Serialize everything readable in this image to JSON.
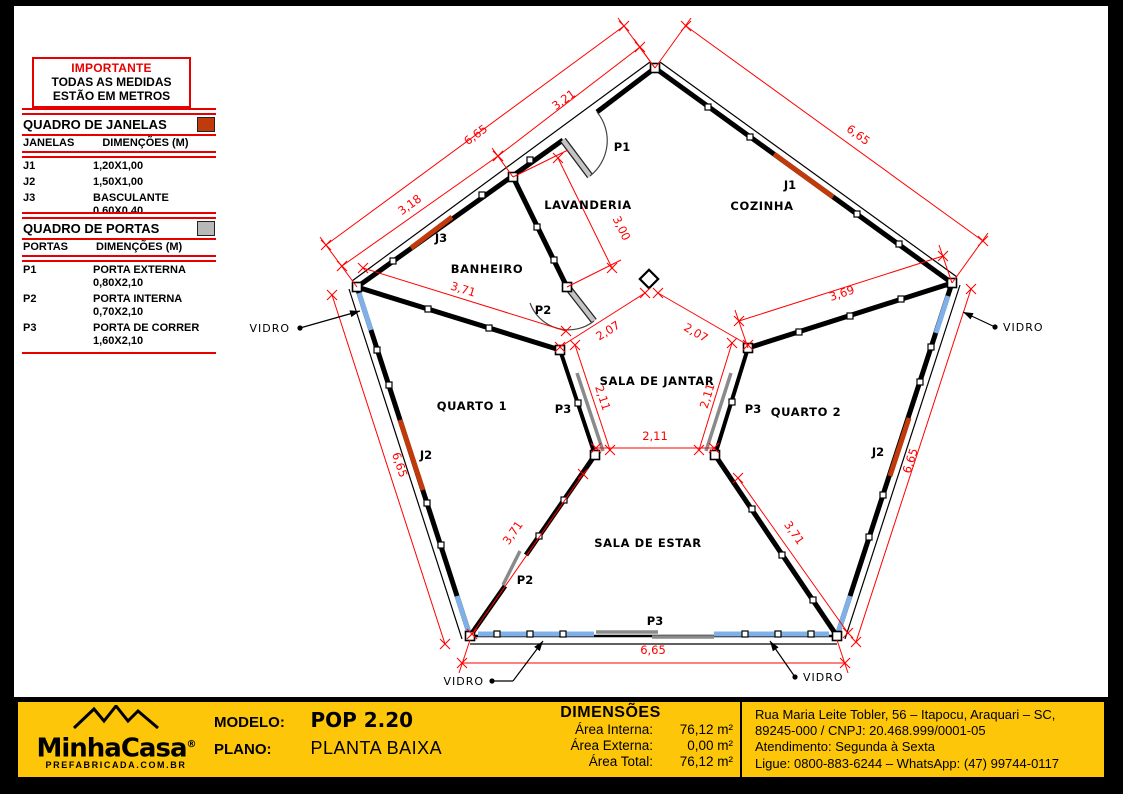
{
  "notice": {
    "title": "IMPORTANTE",
    "line1": "TODAS AS MEDIDAS",
    "line2": "ESTÃO EM METROS"
  },
  "windows_table": {
    "title": "QUADRO DE JANELAS",
    "col_item": "JANELAS",
    "col_dim": "DIMENÇÕES (M)",
    "rows": [
      {
        "id": "J1",
        "dim": "1,20X1,00",
        "dim2": ""
      },
      {
        "id": "J2",
        "dim": "1,50X1,00",
        "dim2": ""
      },
      {
        "id": "J3",
        "dim": "BASCULANTE",
        "dim2": "0,60X0,40"
      }
    ]
  },
  "doors_table": {
    "title": "QUADRO DE PORTAS",
    "col_item": "PORTAS",
    "col_dim": "DIMENÇÕES (M)",
    "rows": [
      {
        "id": "P1",
        "name": "PORTA EXTERNA",
        "dim": "0,80X2,10"
      },
      {
        "id": "P2",
        "name": "PORTA INTERNA",
        "dim": "0,70X2,10"
      },
      {
        "id": "P3",
        "name": "PORTA DE CORRER",
        "dim": "1,60X2,10"
      }
    ]
  },
  "plan": {
    "colors": {
      "dim": "#ff0000",
      "window": "#c03a0b",
      "glass": "#7fb0e8",
      "door": "#8a8a8a",
      "wall": "#000000"
    },
    "rooms": [
      {
        "t": "LAVANDERIA",
        "x": 588,
        "y": 209
      },
      {
        "t": "COZINHA",
        "x": 762,
        "y": 210
      },
      {
        "t": "BANHEIRO",
        "x": 487,
        "y": 273
      },
      {
        "t": "SALA DE JANTAR",
        "x": 657,
        "y": 385
      },
      {
        "t": "QUARTO 1",
        "x": 472,
        "y": 410
      },
      {
        "t": "QUARTO 2",
        "x": 806,
        "y": 416
      },
      {
        "t": "SALA DE ESTAR",
        "x": 648,
        "y": 547
      }
    ],
    "door_labels": [
      {
        "t": "P1",
        "x": 622,
        "y": 151
      },
      {
        "t": "P2",
        "x": 543,
        "y": 314
      },
      {
        "t": "P2",
        "x": 525,
        "y": 584
      },
      {
        "t": "P3",
        "x": 563,
        "y": 413
      },
      {
        "t": "P3",
        "x": 753,
        "y": 413
      },
      {
        "t": "P3",
        "x": 655,
        "y": 625
      }
    ],
    "window_labels": [
      {
        "t": "J3",
        "x": 441,
        "y": 242
      },
      {
        "t": "J1",
        "x": 790,
        "y": 189
      },
      {
        "t": "J2",
        "x": 426,
        "y": 459
      },
      {
        "t": "J2",
        "x": 878,
        "y": 456
      }
    ],
    "vidro_labels": [
      {
        "t": "VIDRO",
        "tx": 290,
        "ty": 332,
        "anchor": "end",
        "dot": [
          300,
          328
        ],
        "pts": [
          [
            300,
            328
          ],
          [
            360,
            311
          ]
        ]
      },
      {
        "t": "VIDRO",
        "tx": 1003,
        "ty": 331,
        "anchor": "start",
        "dot": [
          995,
          327
        ],
        "pts": [
          [
            995,
            327
          ],
          [
            963,
            312
          ]
        ]
      },
      {
        "t": "VIDRO",
        "tx": 484,
        "ty": 685,
        "anchor": "end",
        "dot": [
          492,
          681
        ],
        "pts": [
          [
            492,
            681
          ],
          [
            513,
            681
          ],
          [
            543,
            641
          ]
        ]
      },
      {
        "t": "VIDRO",
        "tx": 803,
        "ty": 681,
        "anchor": "start",
        "dot": [
          795,
          677
        ],
        "pts": [
          [
            795,
            677
          ],
          [
            770,
            641
          ]
        ]
      }
    ],
    "dims": [
      {
        "label": "6,65",
        "x1": 624,
        "y1": 26,
        "x2": 326,
        "y2": 245,
        "lx": 478,
        "ly": 138,
        "rot": -36,
        "ext": [
          [
            655,
            68,
            618,
            18
          ],
          [
            357,
            287,
            320,
            237
          ]
        ]
      },
      {
        "label": "3,21",
        "x1": 640,
        "y1": 47,
        "x2": 498,
        "y2": 156,
        "lx": 566,
        "ly": 103,
        "rot": -36,
        "ext": [
          [
            655,
            68,
            634,
            39
          ],
          [
            513,
            177,
            492,
            148
          ]
        ]
      },
      {
        "label": "3,18",
        "x1": 498,
        "y1": 156,
        "x2": 342,
        "y2": 266,
        "lx": 412,
        "ly": 208,
        "rot": -36,
        "ext": []
      },
      {
        "label": "6,65",
        "x1": 686,
        "y1": 26,
        "x2": 983,
        "y2": 241,
        "lx": 856,
        "ly": 138,
        "rot": 36,
        "ext": [
          [
            655,
            68,
            691,
            18
          ],
          [
            952,
            283,
            988,
            233
          ]
        ]
      },
      {
        "label": "3,00",
        "x1": 558,
        "y1": 158,
        "x2": 612,
        "y2": 268,
        "lx": 618,
        "ly": 230,
        "rot": 64,
        "ext": [
          [
            513,
            177,
            568,
            150
          ],
          [
            567,
            287,
            621,
            260
          ]
        ]
      },
      {
        "label": "3,71",
        "x1": 363,
        "y1": 268,
        "x2": 566,
        "y2": 331,
        "lx": 462,
        "ly": 293,
        "rot": 17,
        "ext": []
      },
      {
        "label": "3,69",
        "x1": 739,
        "y1": 321,
        "x2": 943,
        "y2": 256,
        "lx": 843,
        "ly": 297,
        "rot": -18,
        "ext": [
          [
            748,
            348,
            735,
            310
          ],
          [
            952,
            283,
            939,
            245
          ]
        ]
      },
      {
        "label": "2,07",
        "x1": 645,
        "y1": 293,
        "x2": 560,
        "y2": 347,
        "lx": 610,
        "ly": 334,
        "rot": -32,
        "ext": []
      },
      {
        "label": "2,07",
        "x1": 658,
        "y1": 293,
        "x2": 748,
        "y2": 345,
        "lx": 694,
        "ly": 336,
        "rot": 30,
        "ext": []
      },
      {
        "label": "2,11",
        "x1": 575,
        "y1": 345,
        "x2": 610,
        "y2": 450,
        "lx": 599,
        "ly": 399,
        "rot": 72,
        "ext": []
      },
      {
        "label": "2,11",
        "x1": 732,
        "y1": 343,
        "x2": 699,
        "y2": 450,
        "lx": 711,
        "ly": 397,
        "rot": -73,
        "ext": []
      },
      {
        "label": "2,11",
        "x1": 596,
        "y1": 448,
        "x2": 714,
        "y2": 448,
        "lx": 655,
        "ly": 440,
        "rot": 0,
        "ext": []
      },
      {
        "label": "6,65",
        "x1": 332,
        "y1": 295,
        "x2": 445,
        "y2": 644,
        "lx": 396,
        "ly": 466,
        "rot": 72,
        "ext": []
      },
      {
        "label": "6,65",
        "x1": 971,
        "y1": 289,
        "x2": 856,
        "y2": 642,
        "lx": 914,
        "ly": 462,
        "rot": -72,
        "ext": []
      },
      {
        "label": "3,71",
        "x1": 583,
        "y1": 474,
        "x2": 472,
        "y2": 634,
        "lx": 516,
        "ly": 535,
        "rot": -55,
        "ext": []
      },
      {
        "label": "3,71",
        "x1": 738,
        "y1": 478,
        "x2": 848,
        "y2": 633,
        "lx": 791,
        "ly": 535,
        "rot": 55,
        "ext": []
      },
      {
        "label": "6,65",
        "x1": 462,
        "y1": 663,
        "x2": 845,
        "y2": 663,
        "lx": 653,
        "ly": 654,
        "rot": 0,
        "ext": [
          [
            470,
            640,
            459,
            673
          ],
          [
            837,
            640,
            848,
            673
          ]
        ]
      }
    ]
  },
  "footer": {
    "logo": {
      "name": "MinhaCasa",
      "reg": "®",
      "sub": "PREFABRICADA.COM.BR"
    },
    "modelo_label": "MODELO:",
    "modelo_value": "POP 2.20",
    "plano_label": "PLANO:",
    "plano_value": "PLANTA BAIXA",
    "dimensoes": {
      "title": "DIMENSÕES",
      "rows": [
        {
          "label": "Área Interna:",
          "value": "76,12 m²"
        },
        {
          "label": "Área Externa:",
          "value": "0,00 m²"
        },
        {
          "label": "Área Total:",
          "value": "76,12 m²"
        }
      ]
    },
    "address_line1": "Rua Maria Leite Tobler, 56 – Itapocu, Araquari – SC,",
    "address_line2": "89245-000 / CNPJ: 20.468.999/0001-05",
    "address_line3": "Atendimento: Segunda à Sexta",
    "address_line4": "Ligue: 0800-883-6244 – WhatsApp: (47) 99744-0117",
    "brand_yellow": "#fdc608"
  }
}
